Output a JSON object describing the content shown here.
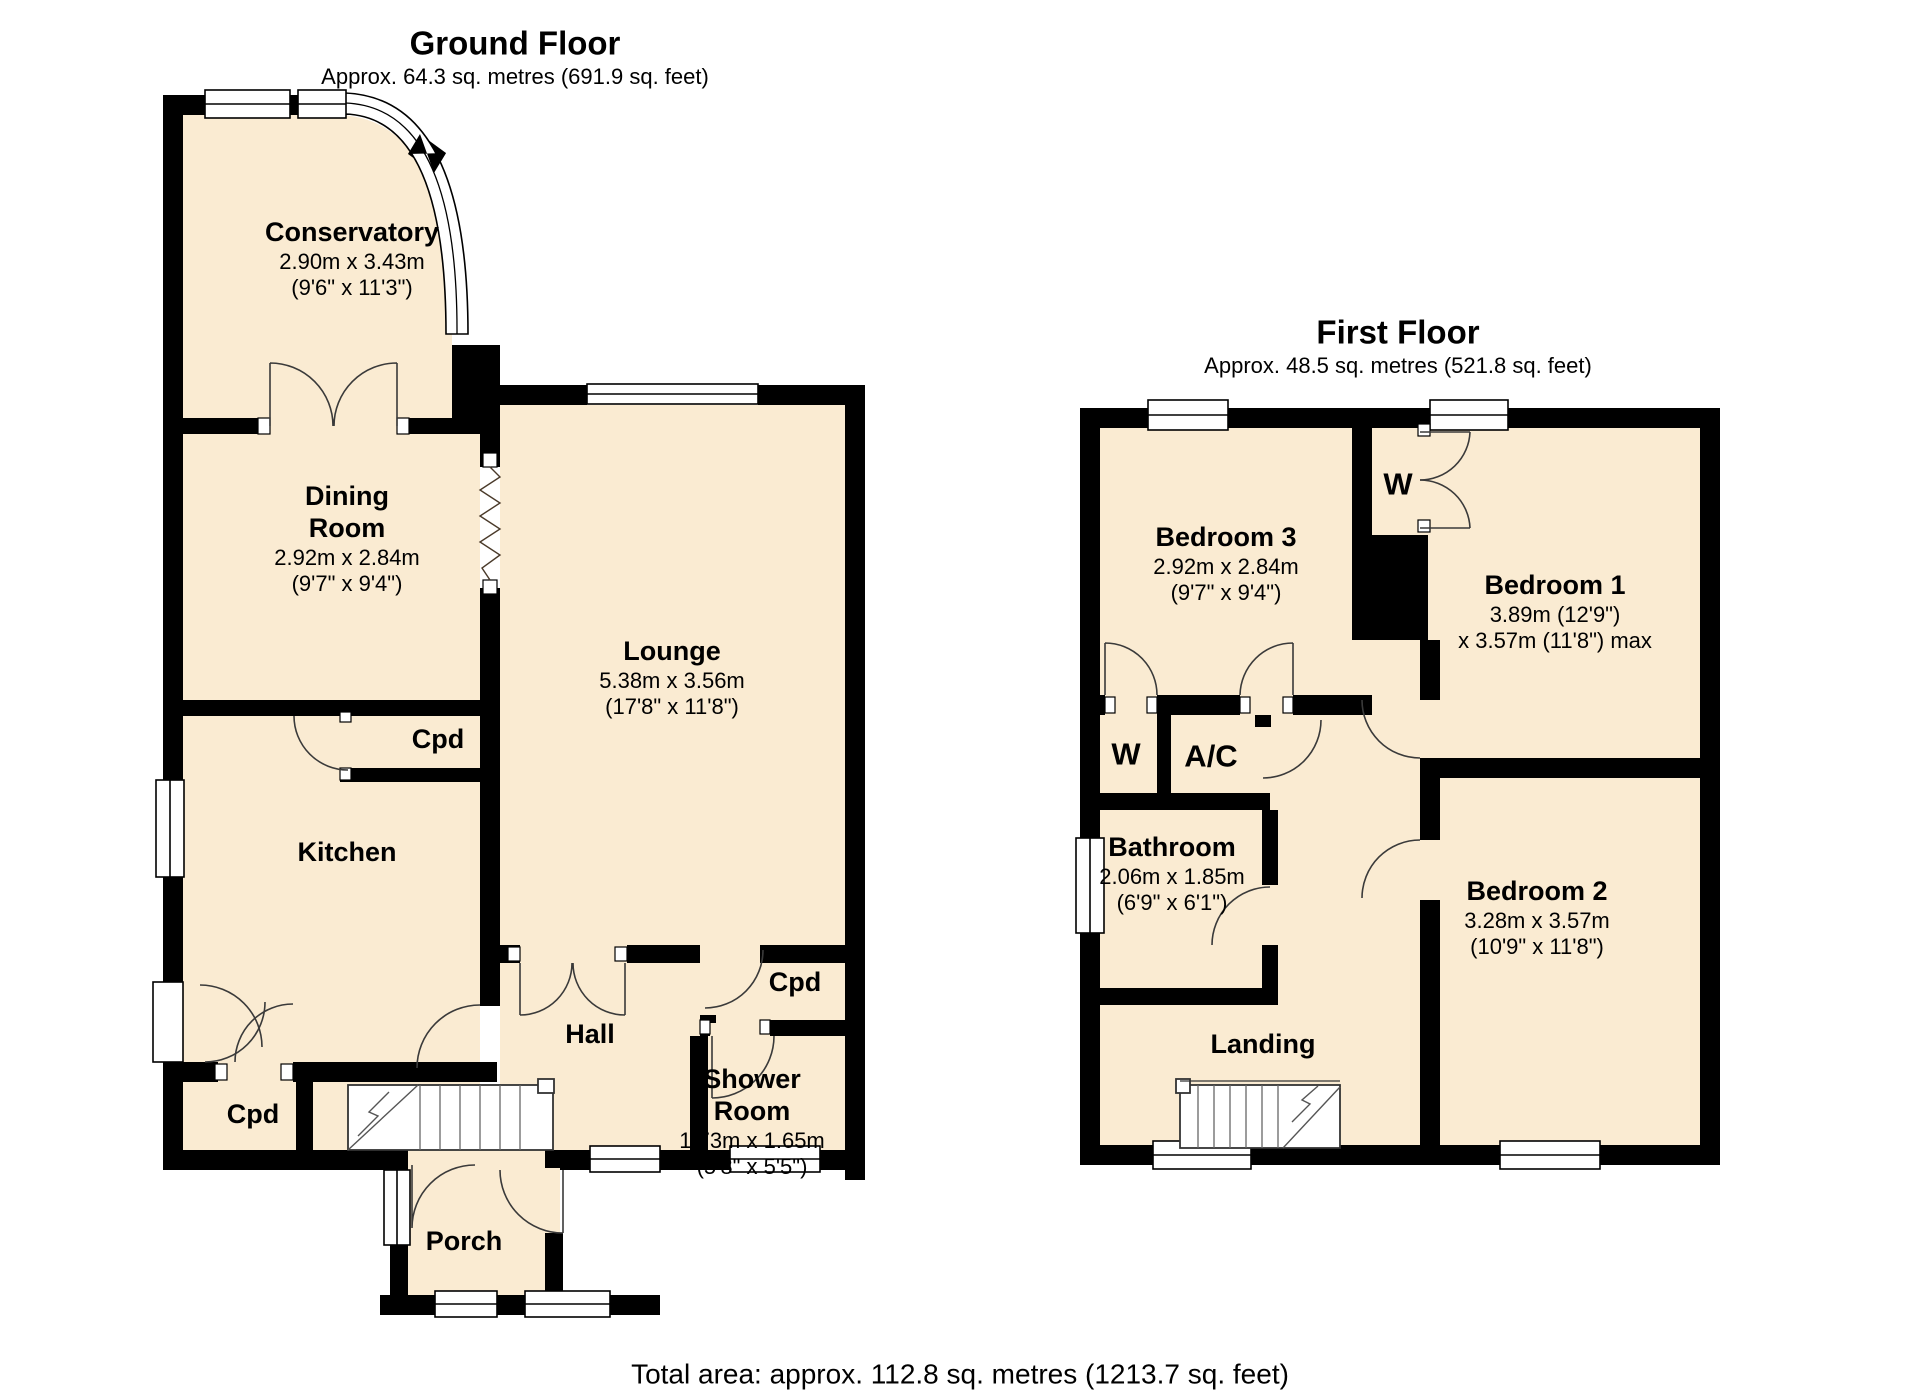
{
  "ground_floor": {
    "title": "Ground Floor",
    "subtitle": "Approx. 64.3 sq. metres (691.9 sq. feet)",
    "rooms": {
      "conservatory": {
        "name": "Conservatory",
        "metric": "2.90m x 3.43m",
        "imperial": "(9'6\" x 11'3\")"
      },
      "dining_room": {
        "name_line1": "Dining",
        "name_line2": "Room",
        "metric": "2.92m x 2.84m",
        "imperial": "(9'7\" x 9'4\")"
      },
      "lounge": {
        "name": "Lounge",
        "metric": "5.38m x 3.56m",
        "imperial": "(17'8\" x 11'8\")"
      },
      "kitchen": {
        "name": "Kitchen"
      },
      "hall": {
        "name": "Hall"
      },
      "shower_room": {
        "name_line1": "Shower",
        "name_line2": "Room",
        "metric": "1.73m x 1.65m",
        "imperial": "(5'8\" x 5'5\")"
      },
      "porch": {
        "name": "Porch"
      },
      "cpd_kitchen": {
        "name": "Cpd"
      },
      "cpd_hall": {
        "name": "Cpd"
      },
      "cpd_under_stairs": {
        "name": "Cpd"
      }
    }
  },
  "first_floor": {
    "title": "First Floor",
    "subtitle": "Approx. 48.5 sq. metres (521.8 sq. feet)",
    "rooms": {
      "bedroom_1": {
        "name": "Bedroom 1",
        "metric": "3.89m (12'9\")",
        "imperial": "x 3.57m (11'8\") max"
      },
      "bedroom_2": {
        "name": "Bedroom 2",
        "metric": "3.28m x 3.57m",
        "imperial": "(10'9\" x 11'8\")"
      },
      "bedroom_3": {
        "name": "Bedroom 3",
        "metric": "2.92m x 2.84m",
        "imperial": "(9'7\" x 9'4\")"
      },
      "bathroom": {
        "name": "Bathroom",
        "metric": "2.06m x 1.85m",
        "imperial": "(6'9\" x 6'1\")"
      },
      "landing": {
        "name": "Landing"
      },
      "wardrobe_top": {
        "name": "W"
      },
      "wardrobe_left": {
        "name": "W"
      },
      "airing_cupboard": {
        "name": "A/C"
      }
    }
  },
  "footer": {
    "total_area": "Total area: approx. 112.8 sq. metres (1213.7 sq. feet)"
  },
  "colors": {
    "room_fill": "#FAEBD2",
    "wall": "#000000",
    "door_line": "#3a3a3a"
  }
}
